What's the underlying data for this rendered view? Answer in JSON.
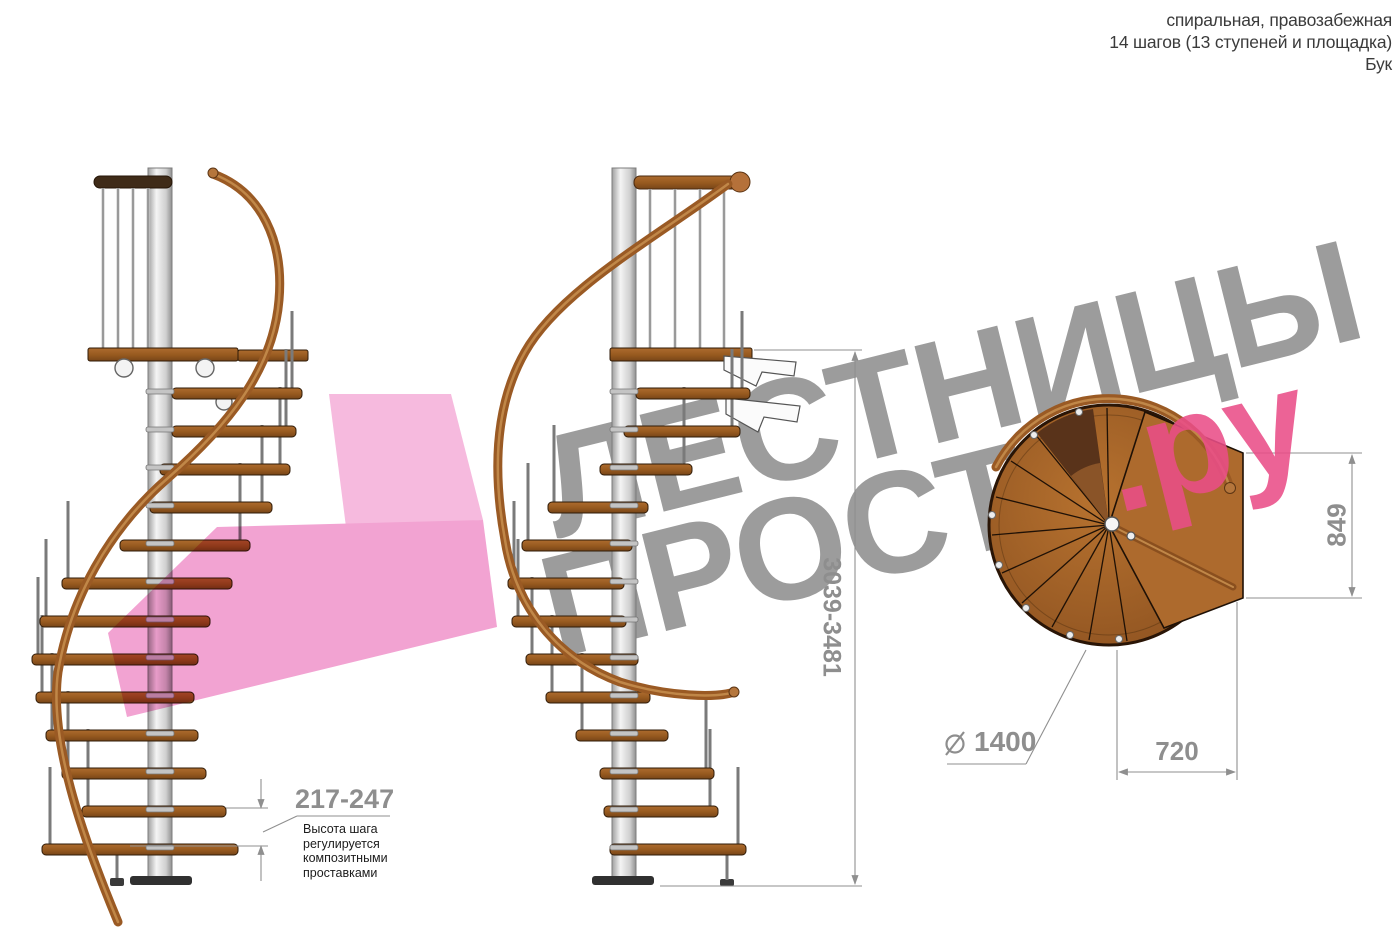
{
  "header": {
    "line1": "спиральная, правозабежная",
    "line2": "14 шагов (13 ступеней и площадка)",
    "line3": "Бук"
  },
  "watermark": {
    "word1": "ЛЕСТНИЦЫ",
    "word2": "ПРОСТО",
    "suffix": ".ру",
    "gray_color": "#9c9c9c",
    "pink_color": "#e94d87"
  },
  "dimensions": {
    "step_height": {
      "value": "217-247",
      "note_lines": [
        "Высота шага",
        "регулируется",
        "композитными",
        "проставками"
      ]
    },
    "total_height": {
      "value": "3039-3481"
    },
    "platform_depth": {
      "value": "849"
    },
    "platform_width": {
      "value": "720"
    },
    "diameter": {
      "symbol": "⌀",
      "value": "1400"
    }
  },
  "colors": {
    "wood": "#a8662c",
    "wood_dark": "#7e4b1d",
    "handrail": "#9a5a24",
    "pole": "#d9d9d9",
    "dimension_gray": "#8f8f8f",
    "arrow_pink": "#f2a3d2"
  }
}
